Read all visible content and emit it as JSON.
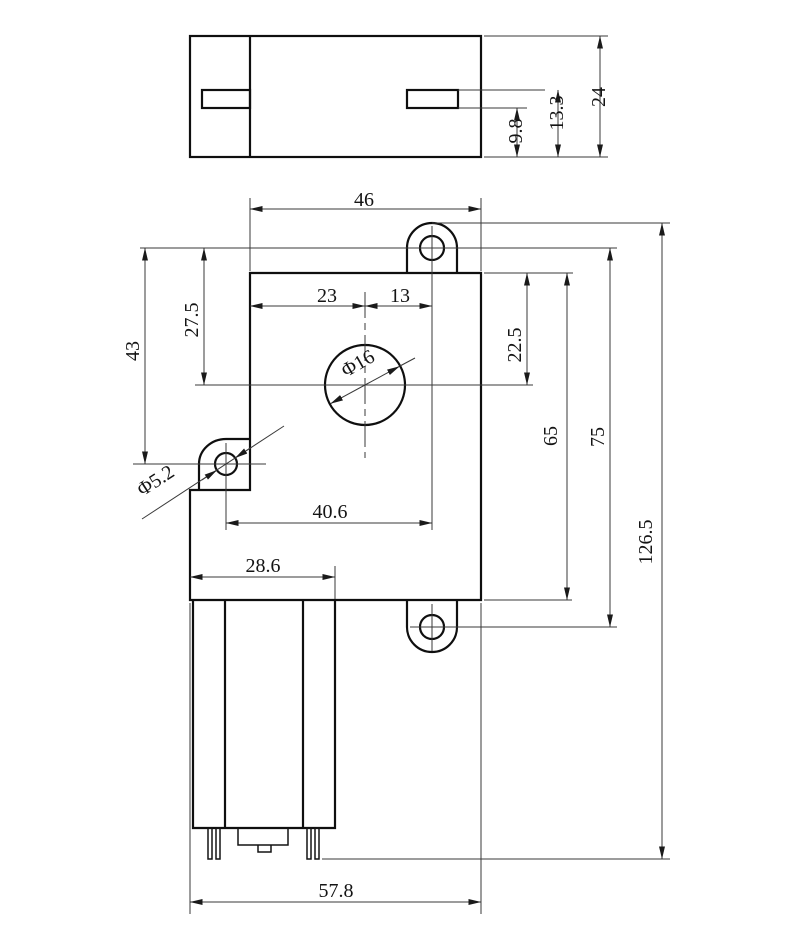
{
  "drawing": {
    "line_color": "#0f0f0f",
    "background_color": "#ffffff"
  },
  "top_view": {
    "height": "24",
    "slot_upper": "13.3",
    "slot_lower": "9.8"
  },
  "front_view": {
    "top_width": "46",
    "center_left": "23",
    "center_right": "13",
    "upper_hole_drop": "27.5",
    "left_hole_drop": "43",
    "shaft_drop": "22.5",
    "body_height": "65",
    "hole_pitch": "75",
    "overall_height": "126.5",
    "hole_span": "40.6",
    "motor_width": "28.6",
    "overall_width": "57.8",
    "shaft_dia": "Φ16",
    "mount_hole_dia": "Φ5.2"
  }
}
